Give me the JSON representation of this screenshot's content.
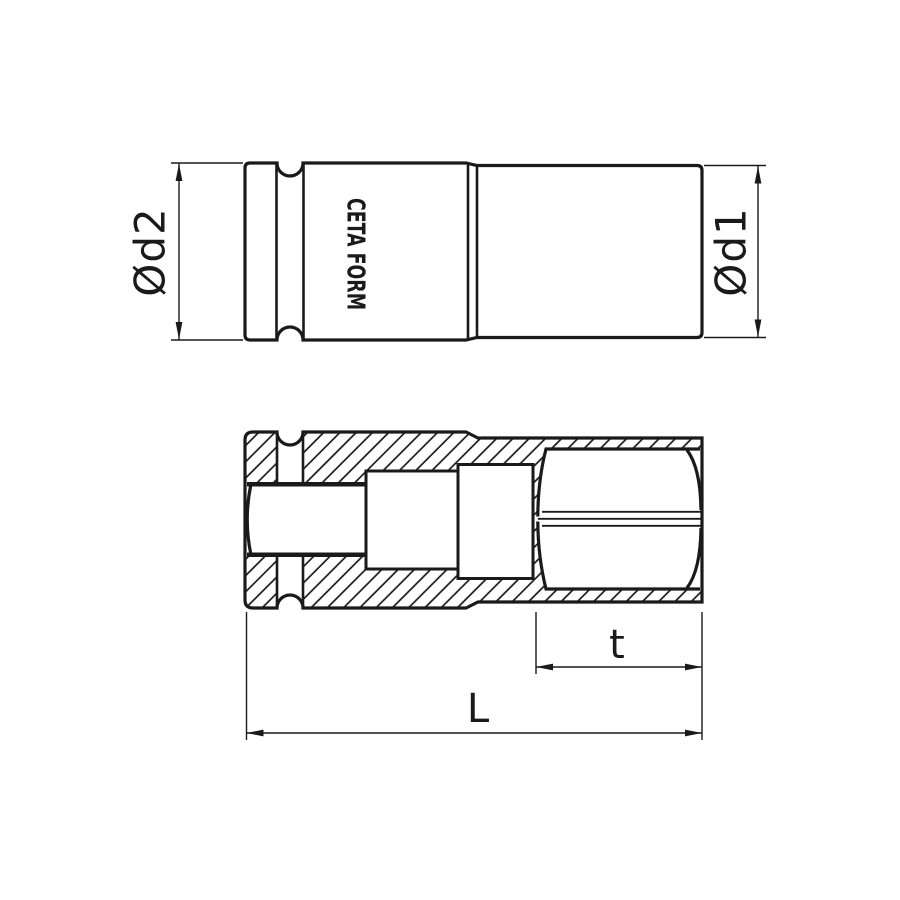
{
  "drawing": {
    "brand": "CETA FORM",
    "dimensions": {
      "d2": "Ød2",
      "d1": "Ød1",
      "t": "t",
      "L": "L"
    },
    "colors": {
      "line": "#1a1a1a",
      "background": "#ffffff"
    }
  }
}
